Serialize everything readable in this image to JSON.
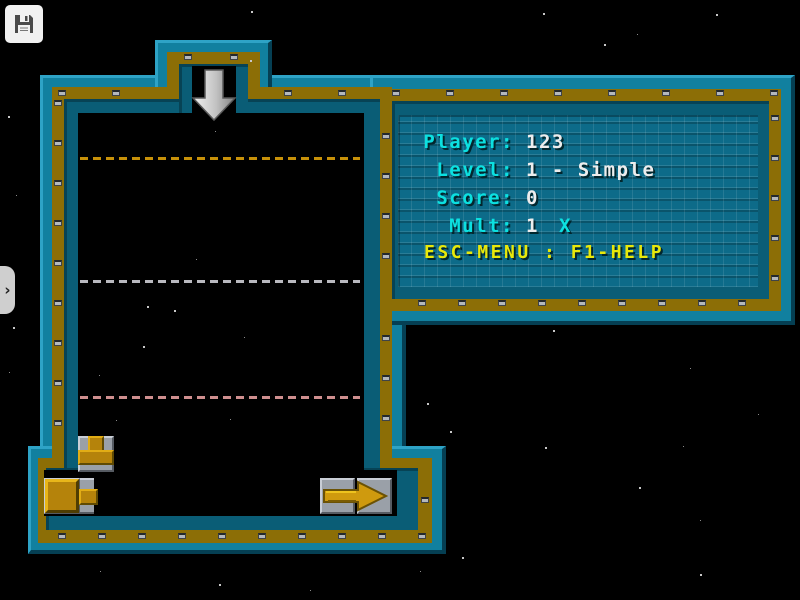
{
  "hud": {
    "rows": [
      {
        "label": "Player:",
        "value": "123"
      },
      {
        "label": "Level:",
        "value": "1 - Simple"
      },
      {
        "label": "Score:",
        "value": "0"
      },
      {
        "label": "Mult:",
        "value": "1",
        "suffix": "X"
      }
    ],
    "footer": "ESC-MENU : F1-HELP"
  },
  "chrome": {
    "sidebar_toggle_glyph": "›"
  },
  "colors": {
    "hud_label_cyan": "#0ce0e0",
    "hud_value_white": "#ededed",
    "hud_footer_yellow": "#e8e80a",
    "wall_teal_outer": "#11809f",
    "wall_teal_inner": "#0a5d76",
    "wall_gold": "#8c6e06",
    "pipe_gold": "#c9940c",
    "tile_gray": "#9aa0a8"
  },
  "guides": [
    {
      "y": 157,
      "color": "#c79109"
    },
    {
      "y": 280,
      "color": "#b9b9bf"
    },
    {
      "y": 396,
      "color": "#cf8f8f"
    }
  ],
  "stars": [
    [
      251,
      11,
      2
    ],
    [
      543,
      13,
      2
    ],
    [
      716,
      14,
      2
    ],
    [
      637,
      34,
      1
    ],
    [
      604,
      44,
      2
    ],
    [
      250,
      60,
      2
    ],
    [
      8,
      116,
      2
    ],
    [
      16,
      195,
      1
    ],
    [
      13,
      327,
      2
    ],
    [
      9,
      372,
      1
    ],
    [
      215,
      131,
      1
    ],
    [
      196,
      259,
      1
    ],
    [
      147,
      306,
      2
    ],
    [
      174,
      310,
      2
    ],
    [
      143,
      346,
      2
    ],
    [
      99,
      375,
      1
    ],
    [
      244,
      337,
      1
    ],
    [
      230,
      419,
      1
    ],
    [
      116,
      420,
      1
    ],
    [
      553,
      330,
      2
    ],
    [
      690,
      368,
      1
    ],
    [
      427,
      403,
      2
    ],
    [
      758,
      414,
      1
    ],
    [
      450,
      431,
      2
    ],
    [
      545,
      447,
      2
    ],
    [
      683,
      446,
      1
    ],
    [
      639,
      487,
      2
    ],
    [
      700,
      520,
      1
    ],
    [
      462,
      557,
      2
    ],
    [
      700,
      574,
      2
    ],
    [
      420,
      571,
      1
    ],
    [
      100,
      571,
      1
    ],
    [
      219,
      584,
      2
    ],
    [
      310,
      590,
      1
    ]
  ]
}
